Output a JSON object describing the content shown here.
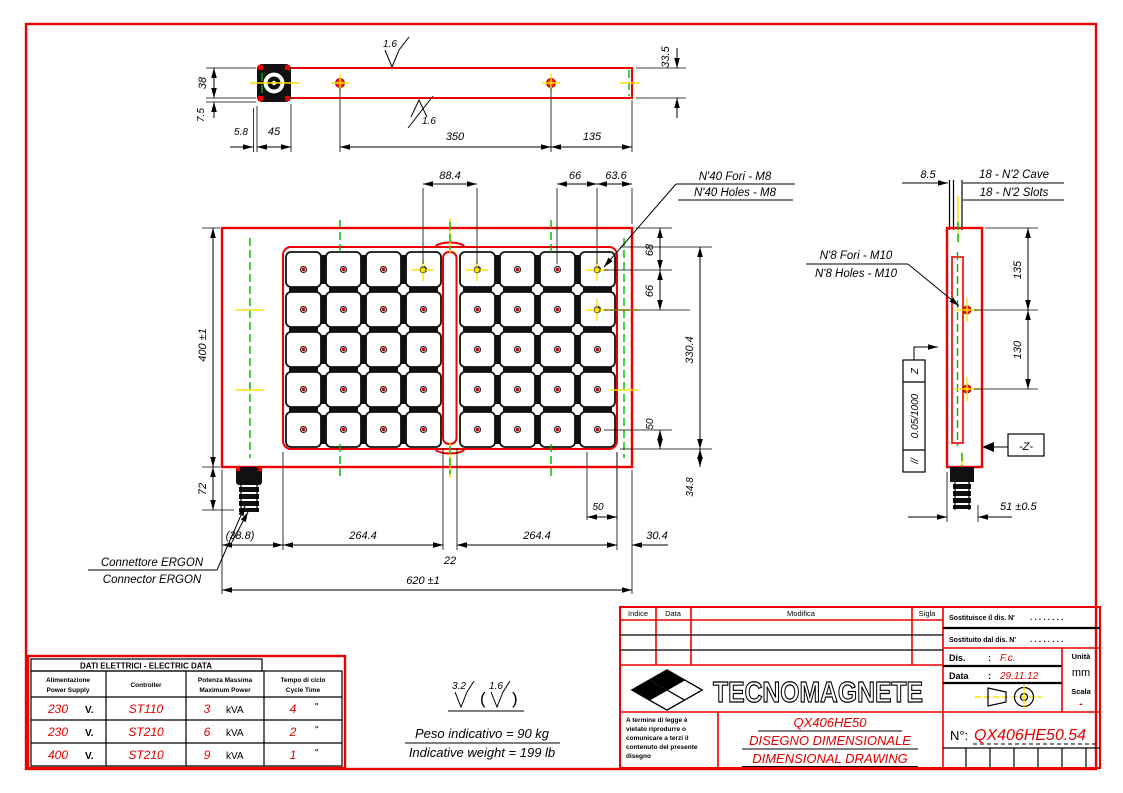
{
  "drawing": {
    "top_view": {
      "finish_top": "1.6",
      "finish_bottom": "1.6",
      "d38": "38",
      "d75": "7.5",
      "d58": "5.8",
      "d45": "45",
      "d350": "350",
      "d135": "135",
      "d335": "33.5"
    },
    "front_view": {
      "d884": "88.4",
      "d66t": "66",
      "d636": "63.6",
      "holes_it": "N'40 Fori - M8",
      "holes_en": "N'40 Holes - M8",
      "d68": "68",
      "d66r": "66",
      "d3304": "330.4",
      "d50r": "50",
      "d348": "34.8",
      "d50b": "50",
      "d388": "(38.8)",
      "d2644a": "264.4",
      "d22": "22",
      "d2644b": "264.4",
      "d304": "30.4",
      "d620": "620 ±1",
      "d400": "400 ±1",
      "d72": "72"
    },
    "side_view": {
      "d85": "8.5",
      "cave_it": "18 - N'2 Cave",
      "cave_en": "18 - N'2 Slots",
      "holes_it": "N'8 Fori - M10",
      "holes_en": "N'8 Holes - M10",
      "d135": "135",
      "d130": "130",
      "fcf_datum": "Z",
      "fcf_tol": "0.05/1000",
      "fcf_sym": "//",
      "datum_label": "-Z-",
      "d51": "51 ±0.5"
    },
    "connector": {
      "it": "Connettore ERGON",
      "en": "Connector ERGON"
    }
  },
  "notes": {
    "finish_a": "3.2",
    "finish_b": "1.6",
    "weight_it": "Peso indicativo = 90 kg",
    "weight_en": "Indicative weight = 199 lb"
  },
  "electric_table": {
    "title": "DATI ELETTRICI - ELECTRIC DATA",
    "headers": [
      {
        "l1": "Alimentazione",
        "l2": "Power Supply"
      },
      {
        "l1": "Controller",
        "l2": ""
      },
      {
        "l1": "Potenza Massima",
        "l2": "Maximum Power"
      },
      {
        "l1": "Tempo di ciclo",
        "l2": "Cycle Time"
      }
    ],
    "rows": [
      {
        "v": "230",
        "vu": "V.",
        "c": "ST110",
        "p": "3",
        "pu": "kVA",
        "t": "4",
        "tu": "\""
      },
      {
        "v": "230",
        "vu": "V.",
        "c": "ST210",
        "p": "6",
        "pu": "kVA",
        "t": "2",
        "tu": "\""
      },
      {
        "v": "400",
        "vu": "V.",
        "c": "ST210",
        "p": "9",
        "pu": "kVA",
        "t": "1",
        "tu": "\""
      }
    ]
  },
  "title_block": {
    "rev_headers": {
      "indice": "Indice",
      "data": "Data",
      "modifica": "Modifica",
      "sigla": "Sigla"
    },
    "sostituisce": "Sostituisce il dis. N'",
    "sostituito": "Sostituito dal dis. N'",
    "dots1": ". . . . . . . .",
    "dots2": ". . . . . . . .",
    "dis_label": "Dis.",
    "dis_sep": ":",
    "dis_value": "F.c.",
    "data_label": "Data",
    "data_sep": ":",
    "data_value": "29.11.12",
    "unita_label": "Unità",
    "unita_value": "mm",
    "scala_label": "Scala",
    "scala_value": "-",
    "company": "TECNOMAGNETE",
    "product": "QX406HE50",
    "doc_it": "DISEGNO DIMENSIONALE",
    "doc_en": "DIMENSIONAL DRAWING",
    "number_label": "N°:",
    "number_value": "QX406HE50.54",
    "legal": [
      "A termine di legge è",
      "vietato riprodurre o",
      "comunicare a terzi il",
      "contenuto del presente",
      "disegno"
    ]
  }
}
